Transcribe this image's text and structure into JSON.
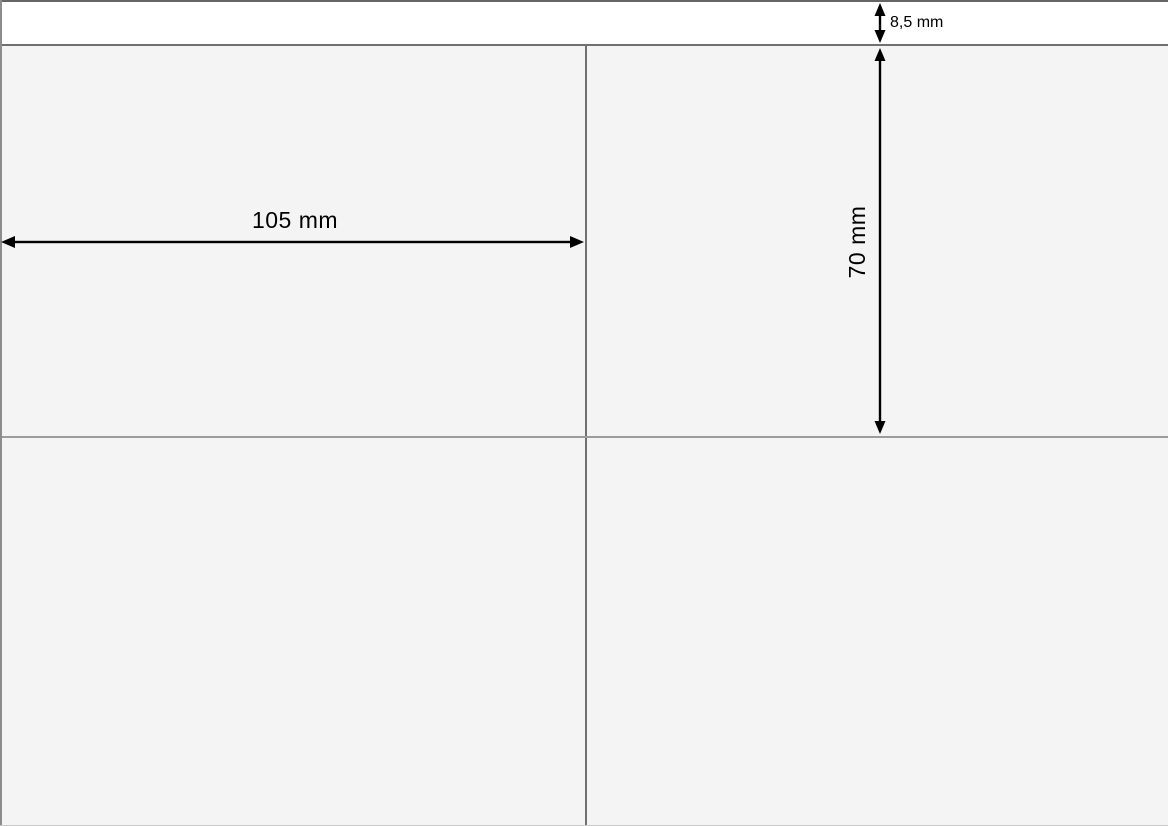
{
  "diagram": {
    "dimensions": {
      "label_width": "105 mm",
      "label_height": "70 mm",
      "top_margin": "8,5 mm"
    },
    "layout": {
      "columns_visible": 2,
      "rows_visible": 2
    },
    "colors": {
      "top_margin_background": "#ffffff",
      "label_background": "#f4f4f4",
      "sheet_top_border": "#666666",
      "grid_line": "#707070",
      "row_line": "#9c9c9c",
      "arrow": "#000000"
    }
  }
}
